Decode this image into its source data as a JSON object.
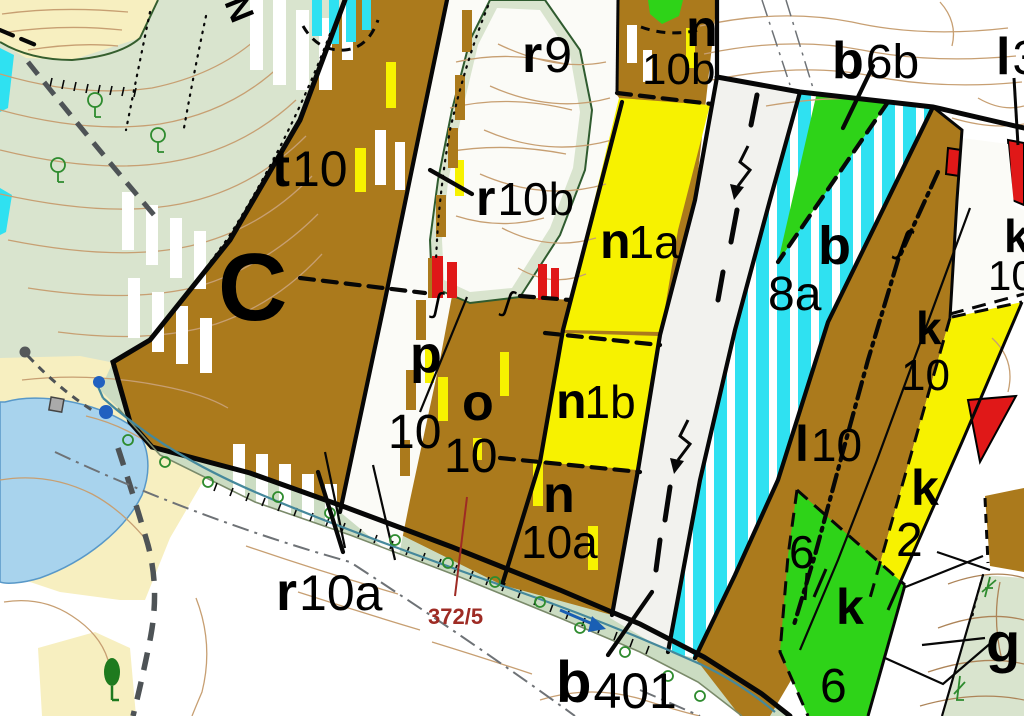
{
  "map": {
    "type": "forest-stand-cadastral-map",
    "labels": {
      "north_mark": "N",
      "c_big": "C",
      "t10": {
        "letter": "t",
        "num": "10"
      },
      "r9": {
        "letter": "r",
        "num": "9"
      },
      "r10b": {
        "letter": "r",
        "num": "10b"
      },
      "r10a": {
        "letter": "r",
        "num": "10a"
      },
      "n_top": {
        "letter": "n",
        "num": "10b"
      },
      "n1a": {
        "letter": "n",
        "num": "1a"
      },
      "n1b": {
        "letter": "n",
        "num": "1b"
      },
      "n10a": {
        "letter": "n",
        "num": "10a"
      },
      "p10": {
        "letter": "p",
        "num": "10"
      },
      "o10": {
        "letter": "o",
        "num": "10"
      },
      "b6b": {
        "letter": "b",
        "num": "6b"
      },
      "b8a": {
        "letter": "b",
        "num": "8a"
      },
      "b401": {
        "letter": "b",
        "num": "401"
      },
      "l3": {
        "letter": "l",
        "num": "3"
      },
      "l10": {
        "letter": "l",
        "num": "10"
      },
      "k10_mid": {
        "letter": "k",
        "num": "10"
      },
      "k10_edge": {
        "letter": "k",
        "num": "10"
      },
      "k2": {
        "letter": "k",
        "num": "2"
      },
      "k6": {
        "letter": "k",
        "num": "6"
      },
      "six_small": "6",
      "g": "g",
      "parcel_ref": "372/5",
      "squiggle": "ʃ"
    },
    "colors": {
      "brown": "#ab7a1c",
      "yellow": "#f7f200",
      "green": "#2ed318",
      "cyan": "#2fe1f1",
      "red": "#e01818",
      "lake": "#a8d3ed",
      "sand": "#f7efc0",
      "sage": "#d9e4ce",
      "band": "#cbdcc2",
      "road": "#f2f2ee",
      "contour": "#c79f72",
      "gcontour": "#ad8458",
      "stream": "#45889b",
      "ink": "#070707",
      "graypath": "#4e5356",
      "graydd": "#6e7276",
      "refred": "#9e2b24",
      "blue": "#1a5fb4"
    }
  }
}
